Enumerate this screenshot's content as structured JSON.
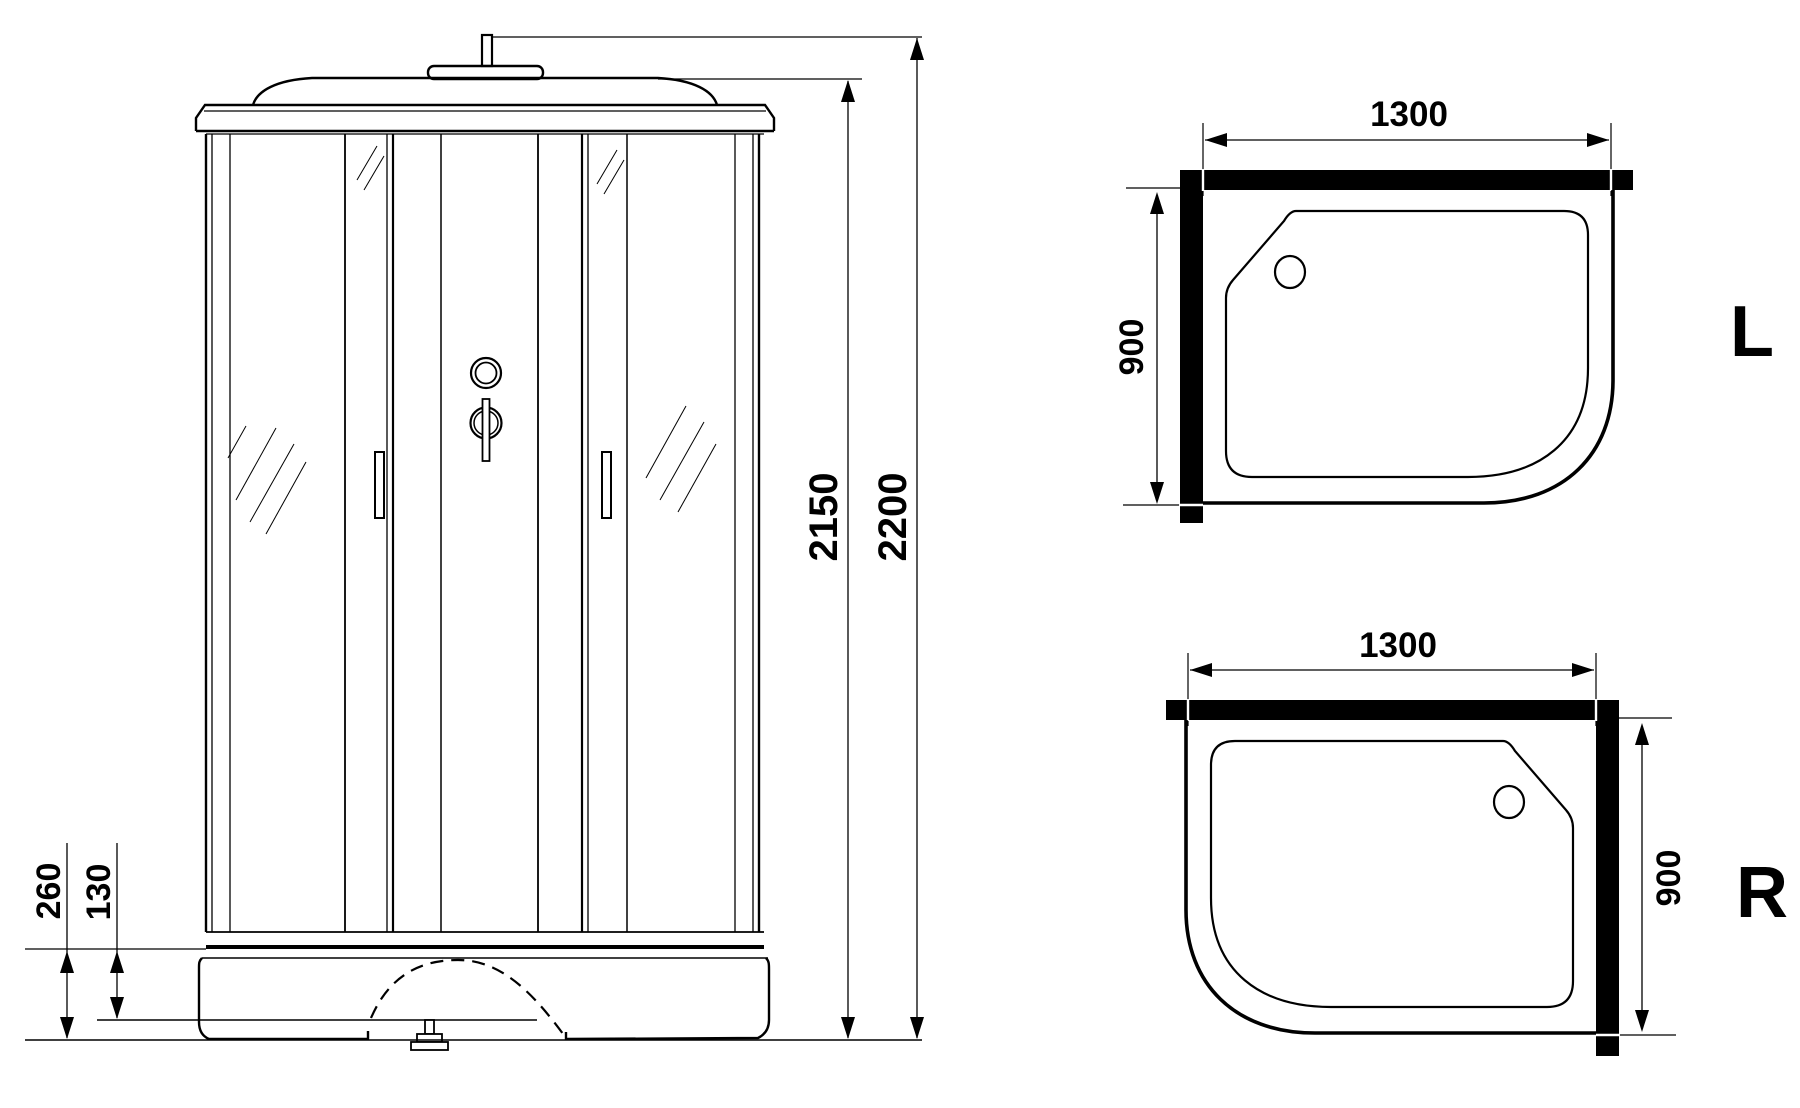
{
  "page": {
    "background_color": "#ffffff",
    "line_color": "#000000",
    "description_labels": []
  },
  "front_view": {
    "dimensions": {
      "overall_height": {
        "value_mm": 2200,
        "label": "2200"
      },
      "cabin_height": {
        "value_mm": 2150,
        "label": "2150"
      },
      "tray_height": {
        "value_mm": 260,
        "label": "260"
      },
      "tray_step_height": {
        "value_mm": 130,
        "label": "130"
      }
    }
  },
  "plan_views": {
    "left": {
      "orientation": "L",
      "width": {
        "value_mm": 1300,
        "label": "1300"
      },
      "depth": {
        "value_mm": 900,
        "label": "900"
      }
    },
    "right": {
      "orientation": "R",
      "width": {
        "value_mm": 1300,
        "label": "1300"
      },
      "depth": {
        "value_mm": 900,
        "label": "900"
      }
    }
  }
}
